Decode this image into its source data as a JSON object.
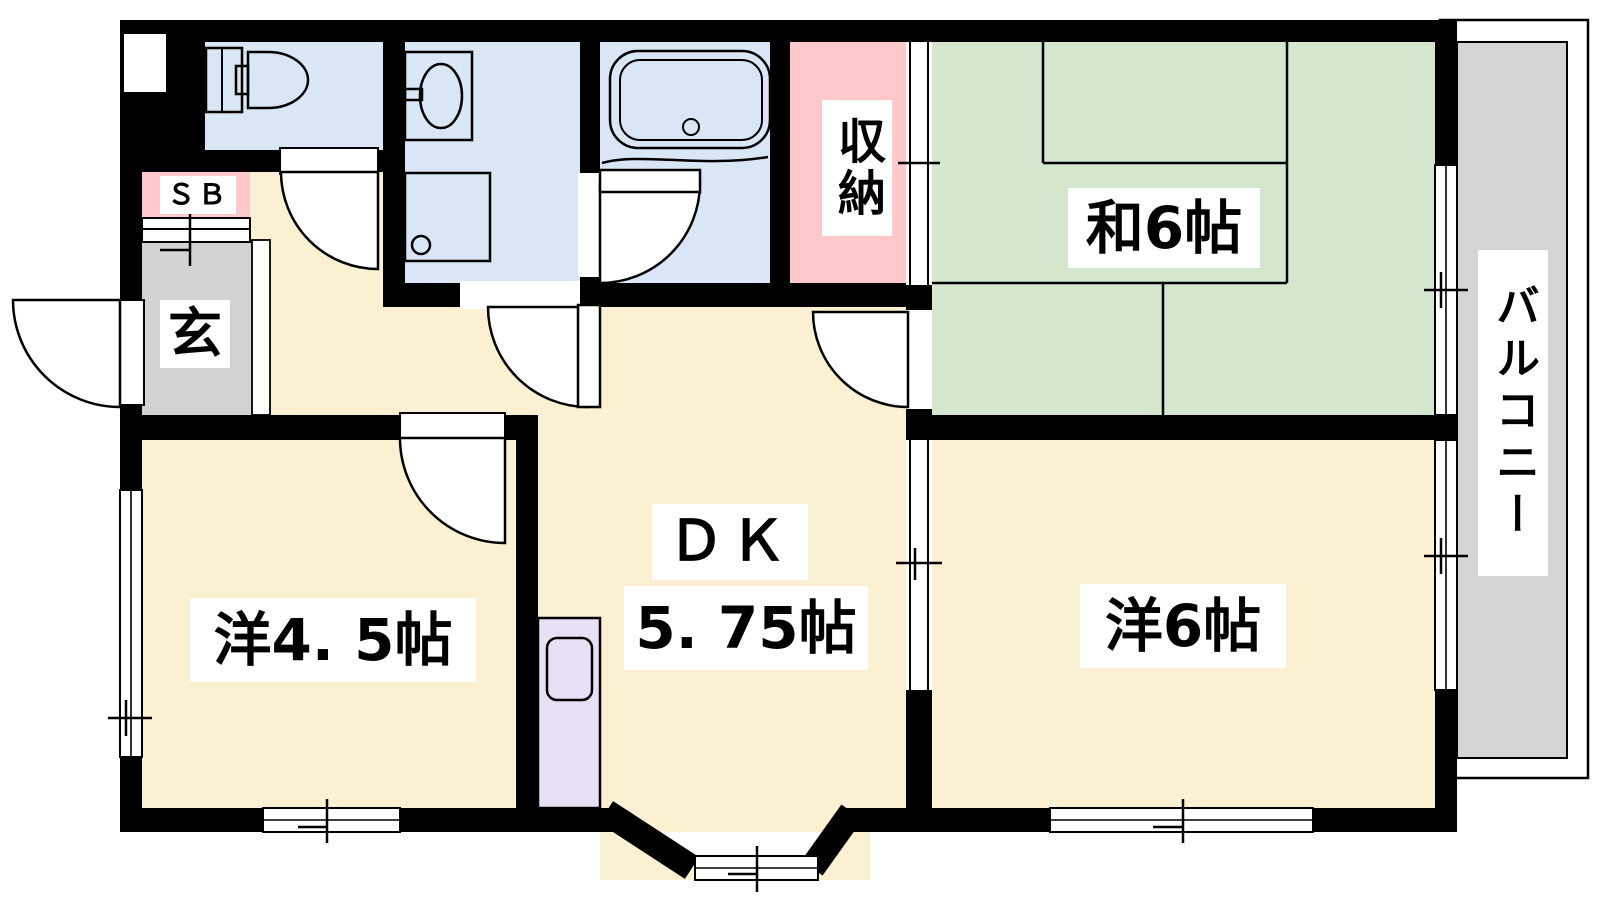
{
  "plan": {
    "title_hint": "apartment floor plan",
    "labels": {
      "shoe_box": "ＳＢ",
      "genkan": "玄",
      "storage": "収納",
      "japanese_room": "和6帖",
      "balcony": "バルコニー",
      "western_room_45": "洋4. 5帖",
      "dk_line1": "ＤＫ",
      "dk_line2": "5. 75帖",
      "western_room_6": "洋6帖"
    },
    "colors": {
      "wall": "#000000",
      "floor_cream": "#FCF0D2",
      "wet_area_blue": "#D9E6F6",
      "storage_pink": "#FFC8CB",
      "tatami_green": "#D4E7CE",
      "genkan_gray": "#D2D2D2",
      "balcony_gray": "#D5D5D5",
      "kitchen_purple": "#E9DFF4",
      "fixture_white": "#FFFFFF"
    },
    "fixtures": [
      "toilet",
      "washbasin",
      "washing-machine-pan",
      "bathtub",
      "kitchen-sink",
      "shoe-box"
    ]
  }
}
